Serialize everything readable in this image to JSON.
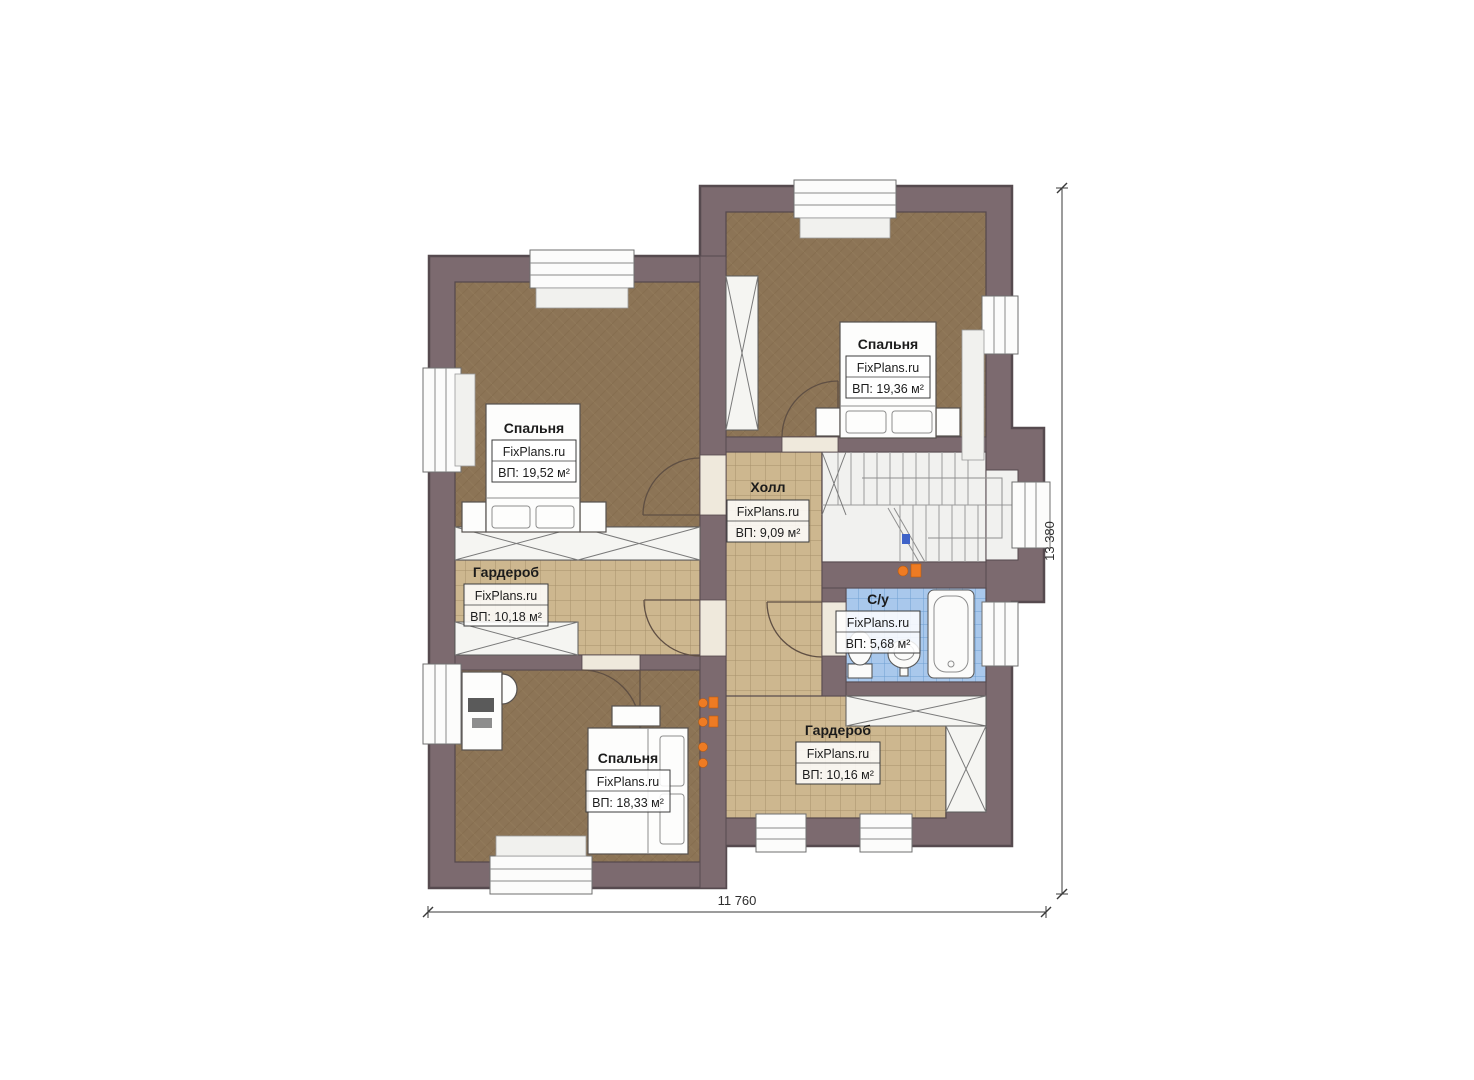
{
  "plan": {
    "type": "floor-plan",
    "rooms": [
      {
        "id": "bedroom-top-left",
        "name": "Спальня",
        "brand": "FixPlans.ru",
        "area_label": "ВП: 19,52 м²"
      },
      {
        "id": "bedroom-top-right",
        "name": "Спальня",
        "brand": "FixPlans.ru",
        "area_label": "ВП: 19,36 м²"
      },
      {
        "id": "hall",
        "name": "Холл",
        "brand": "FixPlans.ru",
        "area_label": "ВП: 9,09 м²"
      },
      {
        "id": "wardrobe-left",
        "name": "Гардероб",
        "brand": "FixPlans.ru",
        "area_label": "ВП: 10,18 м²"
      },
      {
        "id": "bathroom",
        "name": "С/у",
        "brand": "FixPlans.ru",
        "area_label": "ВП: 5,68 м²"
      },
      {
        "id": "bedroom-bottom",
        "name": "Спальня",
        "brand": "FixPlans.ru",
        "area_label": "ВП: 18,33 м²"
      },
      {
        "id": "wardrobe-right",
        "name": "Гардероб",
        "brand": "FixPlans.ru",
        "area_label": "ВП: 10,16 м²"
      }
    ],
    "dimensions": {
      "width_label": "11 760",
      "height_label": "13 380"
    },
    "colors": {
      "wall": "#7c6a6f",
      "wall_outline": "#564a4f",
      "bedroom_floor": "#8c7456",
      "tile_floor": "#cdb78f",
      "tile_grid": "#a7906b",
      "bath_floor": "#a9c8ec",
      "bath_grid": "#6f9fd2",
      "stair_white": "#f1f1ef",
      "accent_orange": "#ee7b23"
    }
  }
}
